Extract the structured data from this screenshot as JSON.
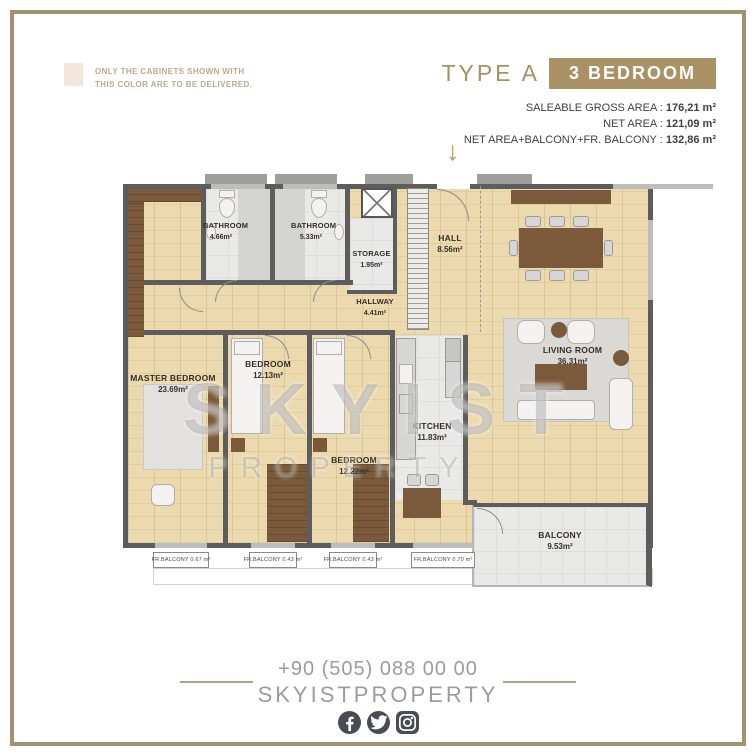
{
  "note": {
    "swatch_color": "#f2e7da",
    "line1": "ONLY THE CABINETS SHOWN WITH",
    "line2": "THIS COLOR ARE TO BE DELIVERED."
  },
  "header": {
    "type_label": "TYPE A",
    "bedroom_badge": "3 BEDROOM"
  },
  "stats": {
    "rows": [
      {
        "label": "SALEABLE GROSS AREA :",
        "value": "176,21 m²"
      },
      {
        "label": "NET AREA :",
        "value": "121,09 m²"
      },
      {
        "label": "NET AREA+BALCONY+FR. BALCONY :",
        "value": "132,86 m²"
      }
    ]
  },
  "colors": {
    "accent_gold": "#ab9265",
    "frame_tan": "#a39173",
    "wall_gray": "#5d5d5d",
    "wood_floor": "#ecd9ae",
    "tile_gray": "#e9e9e7",
    "dark_wood": "#7a5a3a",
    "footer_gray": "#9c9c9c",
    "icon_slate": "#474c55"
  },
  "floorplan": {
    "entrance_arrow": "↓",
    "rooms": {
      "bathroom1": {
        "name": "BATHROOM",
        "area": "4.66m²"
      },
      "bathroom2": {
        "name": "BATHROOM",
        "area": "5.33m²"
      },
      "storage": {
        "name": "STORAGE",
        "area": "1.95m²"
      },
      "hall": {
        "name": "HALL",
        "area": "8.56m²"
      },
      "hallway": {
        "name": "HALLWAY",
        "area": "4.41m²"
      },
      "master_bedroom": {
        "name": "MASTER BEDROOM",
        "area": "23.69m²"
      },
      "bedroom1": {
        "name": "BEDROOM",
        "area": "12.13m²"
      },
      "bedroom2": {
        "name": "BEDROOM",
        "area": "12.22m²"
      },
      "kitchen": {
        "name": "KITCHEN",
        "area": "11.83m²"
      },
      "living_room": {
        "name": "LIVING ROOM",
        "area": "36.31m²"
      },
      "balcony": {
        "name": "BALCONY",
        "area": "9.53m²"
      }
    },
    "fr_balconies": [
      "FR.BALCONY 0.67 m²",
      "FR.BALCONY 0.43 m²",
      "FR.BALCONY 0.43 m²",
      "FR.BALCONY 0.70 m²"
    ],
    "watermark": {
      "line1": "SKYIST",
      "line2": "PROPERTY"
    }
  },
  "footer": {
    "phone": "+90 (505) 088 00 00",
    "brand": "SKYISTPROPERTY",
    "social_icons": [
      "facebook-icon",
      "twitter-icon",
      "instagram-icon"
    ]
  }
}
